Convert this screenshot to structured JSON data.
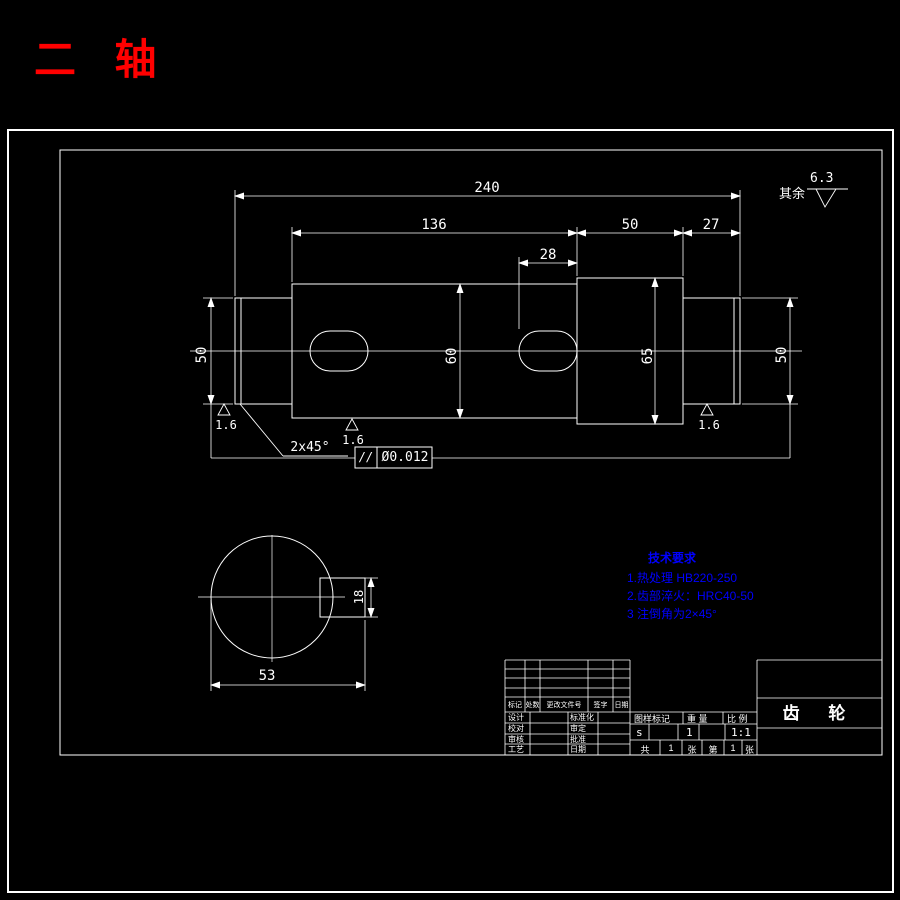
{
  "page": {
    "title": "二 轴"
  },
  "roughness": {
    "general_prefix": "其余",
    "general_value": "6.3",
    "local_values": [
      "1.6",
      "1.6",
      "1.6"
    ]
  },
  "dims": {
    "total": "240",
    "mid": "136",
    "step": "50",
    "right": "27",
    "keyway": "28",
    "dia_left": "50",
    "dia_mid": "60",
    "dia_step": "65",
    "dia_right": "50",
    "key_width": "18",
    "section": "53",
    "chamfer": "2x45°"
  },
  "tolerance": {
    "symbol": "//",
    "value": "Ø0.012"
  },
  "tech": {
    "title": "技术要求",
    "items": [
      "1.热处理  HB220-250",
      "2.齿部淬火：HRC40-50",
      "3 注倒角为2×45°"
    ]
  },
  "title_block": {
    "revision_header": [
      "标记",
      "处数",
      "更改文件号",
      "签字",
      "日期"
    ],
    "staff_rows": [
      [
        "设计",
        "标准化"
      ],
      [
        "校对",
        "审定"
      ],
      [
        "审核",
        "批准"
      ],
      [
        "工艺",
        "日期"
      ]
    ],
    "head": [
      "图样标记",
      "重 量",
      "比 例"
    ],
    "vals": [
      "s",
      "1",
      "1:1"
    ],
    "sheet": [
      "共",
      "1",
      "张",
      "第",
      "1",
      "张"
    ],
    "part_name": "齿 轮"
  }
}
